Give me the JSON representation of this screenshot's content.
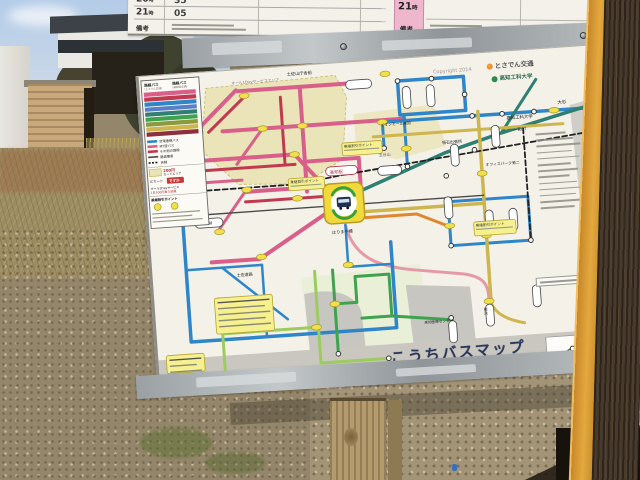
{
  "colors": {
    "pink": "#d75f8a",
    "crimson": "#c0394f",
    "salmon": "#e49aa6",
    "blue": "#2e86c8",
    "teal": "#2f7f72",
    "green": "#3fa24f",
    "lightgreen": "#9ccb5e",
    "gold": "#cdb64f",
    "orange": "#e0862e",
    "jr": "#222222",
    "tram": "#4a4a4a",
    "stopYellow": "#f2e04a",
    "hubYellow": "#f2d93a",
    "hubGreen": "#3aa03a",
    "calloutYellow": "#f6f08e",
    "zoneKhaki": "#eae3b4",
    "zoneKhaki2": "#ece6bc",
    "zoneGreen": "#e2ecca",
    "sea": "#cac7c1",
    "water": "#c8c6c0",
    "grayland": "#d0cec8",
    "titleNavy": "#2b3a5c",
    "icRed": "#c23a3a",
    "operatorOrange": "#e07820",
    "universityGreen": "#2e6b4f"
  },
  "sign": {
    "timetable": {
      "rows": [
        {
          "hour": "20",
          "minute": "35"
        },
        {
          "hour": "21",
          "minute": "05"
        }
      ],
      "hour_suffix": "時",
      "note_label": "備考",
      "right": {
        "hour": "21",
        "hour_suffix": "時",
        "note_label": "備考"
      }
    },
    "map": {
      "copyright": "Copyright 2014",
      "operator_logo": "とさでん交通",
      "university_logo": "高知工科大学",
      "title": "こうちバスマップ",
      "legend": {
        "header_left": "路線バス",
        "header_left_sub": "(とさでん交通)",
        "header_right": "路線バス",
        "header_right_sub": "(高知県交通)",
        "bars": [
          "#d75f8a",
          "#c0394f",
          "#2e86c8",
          "#5b7fc4",
          "#2f7f72",
          "#3fa24f",
          "#8a9a3c",
          "#cdb64f",
          "#8c2f3f"
        ],
        "lines": [
          {
            "label": "空港連絡バス",
            "color": "#2e86c8"
          },
          {
            "label": "MY遊バス",
            "color": "#d75f8a"
          },
          {
            "label": "その他の路線",
            "color": "#c0394f"
          }
        ],
        "tram_label": "路面電車",
        "jr_label": "JR線",
        "zone_price": "200円",
        "zone_label": "カードエリア",
        "ic_label": "ICカード",
        "ic_badge": "ですか",
        "day_label": "オール1Dayサービス",
        "day_price": "1日500円乗り放題",
        "transfer_label": "乗継割引ポイント"
      },
      "zones": [
        {
          "d": "M66,16 L196,12 L206,34 L198,96 L158,118 L92,114 L58,78 Z",
          "f": "zoneKhaki",
          "o": 0.9,
          "dash": true
        },
        {
          "d": "M212,52 L292,48 L302,90 L252,100 L212,86 Z",
          "f": "zoneKhaki2",
          "o": 0.9
        },
        {
          "d": "M148,212 L268,206 L272,292 L152,296 Z",
          "f": "zoneGreen",
          "o": 0.55
        },
        {
          "d": "M150,228 C185,222 205,236 206,252 L208,290 L152,292 Z",
          "f": "water"
        },
        {
          "d": "M252,226 L316,232 L318,286 L256,288 Z",
          "f": "water"
        },
        {
          "d": "M0,284 L456,284 L456,316 L0,316 Z",
          "f": "sea"
        },
        {
          "d": "M428,58 L456,52 L456,204 L434,206 Z",
          "f": "grayland"
        },
        {
          "d": "M388,288 L436,288 L436,314 L388,314 Z",
          "f": "#fdfcf8",
          "s": "#999"
        }
      ],
      "routes": [
        {
          "c": "pink",
          "w": 4,
          "d": "M14,88 H150"
        },
        {
          "c": "crimson",
          "w": 3,
          "d": "M14,98 H150"
        },
        {
          "c": "pink",
          "w": 3,
          "d": "M14,110 H96"
        },
        {
          "c": "pink",
          "w": 4,
          "d": "M150,88 L178,122"
        },
        {
          "c": "pink",
          "w": 4,
          "d": "M96,20 L58,54"
        },
        {
          "c": "crimson",
          "w": 3,
          "d": "M104,27 L66,60"
        },
        {
          "c": "pink",
          "w": 4,
          "d": "M98,21 H206"
        },
        {
          "c": "pink",
          "w": 4,
          "d": "M160,21 V126"
        },
        {
          "c": "crimson",
          "w": 3,
          "d": "M140,30 V96"
        },
        {
          "c": "pink",
          "w": 4,
          "d": "M80,60 H262"
        },
        {
          "c": "pink",
          "w": 3,
          "d": "M120,60 L92,94"
        },
        {
          "c": "pink",
          "w": 4,
          "d": "M160,96 H214 L214,122"
        },
        {
          "c": "pink",
          "w": 4,
          "d": "M98,122 H176"
        },
        {
          "c": "crimson",
          "w": 3,
          "d": "M98,132 H176"
        },
        {
          "c": "pink",
          "w": 3,
          "d": "M98,122 L68,160"
        },
        {
          "c": "pink",
          "w": 4,
          "d": "M176,150 L108,190 H60"
        },
        {
          "c": "salmon",
          "w": 3,
          "d": "M196,162 C202,196 228,206 258,211 L310,219 C330,223 334,231 334,243 V258"
        },
        {
          "c": "blue",
          "w": 3.5,
          "d": "M258,22 H324 V56 H258 Z"
        },
        {
          "c": "blue",
          "w": 3.5,
          "d": "M240,62 H330"
        },
        {
          "c": "blue",
          "w": 3,
          "d": "M262,56 V110"
        },
        {
          "c": "blue",
          "w": 3,
          "d": "M240,62 V88 H200"
        },
        {
          "c": "blue",
          "w": 3.5,
          "d": "M330,62 H446"
        },
        {
          "c": "blue",
          "w": 3.5,
          "d": "M34,150 V268 H240 V182"
        },
        {
          "c": "blue",
          "w": 2.5,
          "d": "M34,196 H110"
        },
        {
          "c": "blue",
          "w": 2.5,
          "d": "M70,196 L132,252"
        },
        {
          "c": "blue",
          "w": 2.5,
          "d": "M110,196 V268"
        },
        {
          "c": "blue",
          "w": 3,
          "d": "M300,146 V190 H380 V146 Z"
        },
        {
          "c": "blue",
          "w": 2.5,
          "d": "M196,162 V204 H240"
        },
        {
          "c": "teal",
          "w": 3.5,
          "d": "M200,134 L300,97 L358,81 L446,60"
        },
        {
          "c": "teal",
          "w": 3,
          "d": "M358,81 L396,30"
        },
        {
          "c": "green",
          "w": 3,
          "d": "M180,206 V290"
        },
        {
          "c": "green",
          "w": 3,
          "d": "M180,240 H202 V214 H236 V256 H206"
        },
        {
          "c": "green",
          "w": 3,
          "d": "M236,256 L296,264"
        },
        {
          "c": "lightgreen",
          "w": 3,
          "d": "M162,206 V298"
        },
        {
          "c": "lightgreen",
          "w": 3,
          "d": "M162,262 H66"
        },
        {
          "c": "lightgreen",
          "w": 3,
          "d": "M66,230 V298"
        },
        {
          "c": "lightgreen",
          "w": 3,
          "d": "M162,298 H232"
        },
        {
          "c": "gold",
          "w": 3.5,
          "d": "M336,58 V250"
        },
        {
          "c": "gold",
          "w": 3,
          "d": "M230,76 H420"
        },
        {
          "c": "gold",
          "w": 3.5,
          "d": "M216,150 H336"
        },
        {
          "c": "gold",
          "w": 3,
          "d": "M336,250 C340,262 352,268 368,272"
        },
        {
          "c": "orange",
          "w": 3,
          "d": "M216,156 H268 L298,170"
        },
        {
          "c": "jr",
          "w": 1.8,
          "dash": "5 3",
          "d": "M28,118 H150 L196,112 L446,86"
        },
        {
          "c": "jr",
          "w": 1.8,
          "dash": "5 3",
          "d": "M380,78 V192"
        },
        {
          "c": "tram",
          "w": 1.4,
          "d": "M14,142 H336"
        },
        {
          "c": "#555555",
          "w": 1.2,
          "d": "M392,312 L432,290"
        }
      ],
      "stops": {
        "yellow": [
          [
            150,
            88
          ],
          [
            104,
            26
          ],
          [
            120,
            60
          ],
          [
            160,
            60
          ],
          [
            100,
            120
          ],
          [
            110,
            188
          ],
          [
            70,
            160
          ],
          [
            240,
            62
          ],
          [
            262,
            90
          ],
          [
            196,
            202
          ],
          [
            180,
            240
          ],
          [
            160,
            262
          ],
          [
            65,
            230
          ],
          [
            336,
            120
          ],
          [
            336,
            182
          ],
          [
            300,
            170
          ],
          [
            334,
            248
          ],
          [
            412,
            62
          ],
          [
            246,
            14
          ],
          [
            150,
            132
          ]
        ],
        "rings": [
          [
            258,
            22
          ],
          [
            292,
            22
          ],
          [
            324,
            40
          ],
          [
            330,
            62
          ],
          [
            360,
            62
          ],
          [
            392,
            62
          ],
          [
            240,
            88
          ],
          [
            300,
            120
          ],
          [
            330,
            96
          ],
          [
            262,
            108
          ],
          [
            180,
            290
          ],
          [
            230,
            298
          ],
          [
            295,
            262
          ],
          [
            380,
            190
          ],
          [
            300,
            190
          ],
          [
            398,
            309
          ],
          [
            414,
            301
          ],
          [
            427,
            294
          ]
        ],
        "capsules_v": [
          [
            266,
            39
          ],
          [
            290,
            39
          ],
          [
            310,
            100
          ],
          [
            352,
            84
          ],
          [
            340,
            168
          ],
          [
            364,
            168
          ],
          [
            296,
            276
          ],
          [
            334,
            262
          ],
          [
            382,
            246
          ],
          [
            300,
            152
          ]
        ],
        "capsules_h": [
          [
            180,
            103,
            32,
            "#b03040"
          ],
          [
            46,
            146,
            28
          ],
          [
            18,
            90,
            24
          ],
          [
            18,
            104,
            24
          ],
          [
            206,
            18,
            26
          ],
          [
            232,
            106,
            24
          ]
        ]
      },
      "hub": {
        "x": 176,
        "y": 120,
        "w": 40,
        "h": 40
      },
      "labels": [
        {
          "x": 148,
          "y": 9,
          "t": "土佐山庁舎前",
          "s": 4.2
        },
        {
          "x": 92,
          "y": 14,
          "t": "オール1Dayサービスエリア",
          "s": 3.8,
          "c": "#777777"
        },
        {
          "x": 416,
          "y": 56,
          "t": "大杉",
          "s": 4.5
        },
        {
          "x": 298,
          "y": 88,
          "t": "領石出張所",
          "s": 4
        },
        {
          "x": 340,
          "y": 113,
          "t": "オフィスパーク第二",
          "s": 3.8
        },
        {
          "x": 364,
          "y": 68,
          "t": "高知工科大学",
          "s": 4.4
        },
        {
          "x": 370,
          "y": 80,
          "t": "一宮BT",
          "s": 4
        },
        {
          "x": 184,
          "y": 110,
          "t": "高知駅",
          "s": 4.4,
          "c": "#b03040"
        },
        {
          "x": 182,
          "y": 170,
          "t": "はりまや橋",
          "s": 4.2
        },
        {
          "x": 238,
          "y": 66,
          "t": "イオンモール高知",
          "s": 3.8
        },
        {
          "x": 234,
          "y": 96,
          "t": "五台山",
          "s": 4,
          "c": "#666666"
        },
        {
          "x": 49,
          "y": 152,
          "t": "朝倉駅前",
          "s": 3.6
        },
        {
          "x": 84,
          "y": 206,
          "t": "土佐道路",
          "s": 4
        },
        {
          "x": 268,
          "y": 266,
          "t": "高知医療センター",
          "s": 3.6
        },
        {
          "x": 186,
          "y": 306,
          "t": "長浜営業所",
          "s": 4
        },
        {
          "x": 331,
          "y": 254,
          "t": "桂浜",
          "s": 3.8,
          "v": true
        }
      ],
      "callouts": [
        {
          "x": 198,
          "y": 80,
          "w": 40,
          "h": 13,
          "t": "乗継割引ポイント"
        },
        {
          "x": 142,
          "y": 112,
          "w": 36,
          "h": 12,
          "t": "乗継割引ポイント"
        },
        {
          "x": 324,
          "y": 168,
          "w": 42,
          "h": 14,
          "t": "乗継割引ポイント"
        },
        {
          "x": 60,
          "y": 226,
          "w": 58,
          "h": 36,
          "t": "",
          "lines": 5
        },
        {
          "x": 8,
          "y": 280,
          "w": 38,
          "h": 18,
          "t": "",
          "lines": 3
        }
      ]
    }
  }
}
